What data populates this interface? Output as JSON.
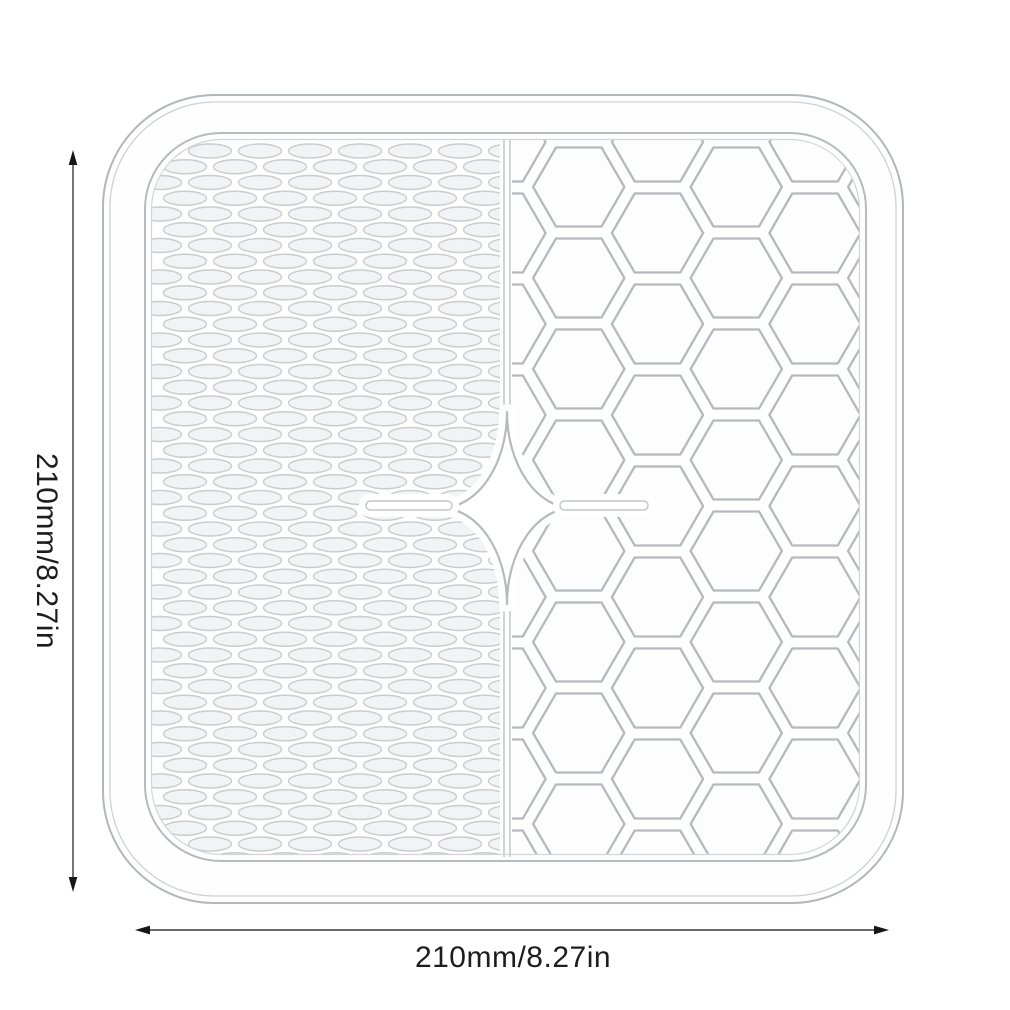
{
  "diagram": {
    "height_label": "210mm/8.27in",
    "width_label": "210mm/8.27in",
    "product": "square-silicone-mat-illustration",
    "left_texture": "oval-bumps",
    "right_texture": "honeycomb"
  },
  "colors": {
    "background": "#ffffff",
    "mat_outline": "#b3b6ba",
    "mat_outline_light": "#ced1d5",
    "pattern_line": "#b6b9bd",
    "oval_line": "#c9ccd0",
    "oval_fill": "#f1f3f5",
    "dimension_line": "#3a3a3a",
    "arrowhead": "#161616",
    "label_text": "#1d1d1d"
  }
}
